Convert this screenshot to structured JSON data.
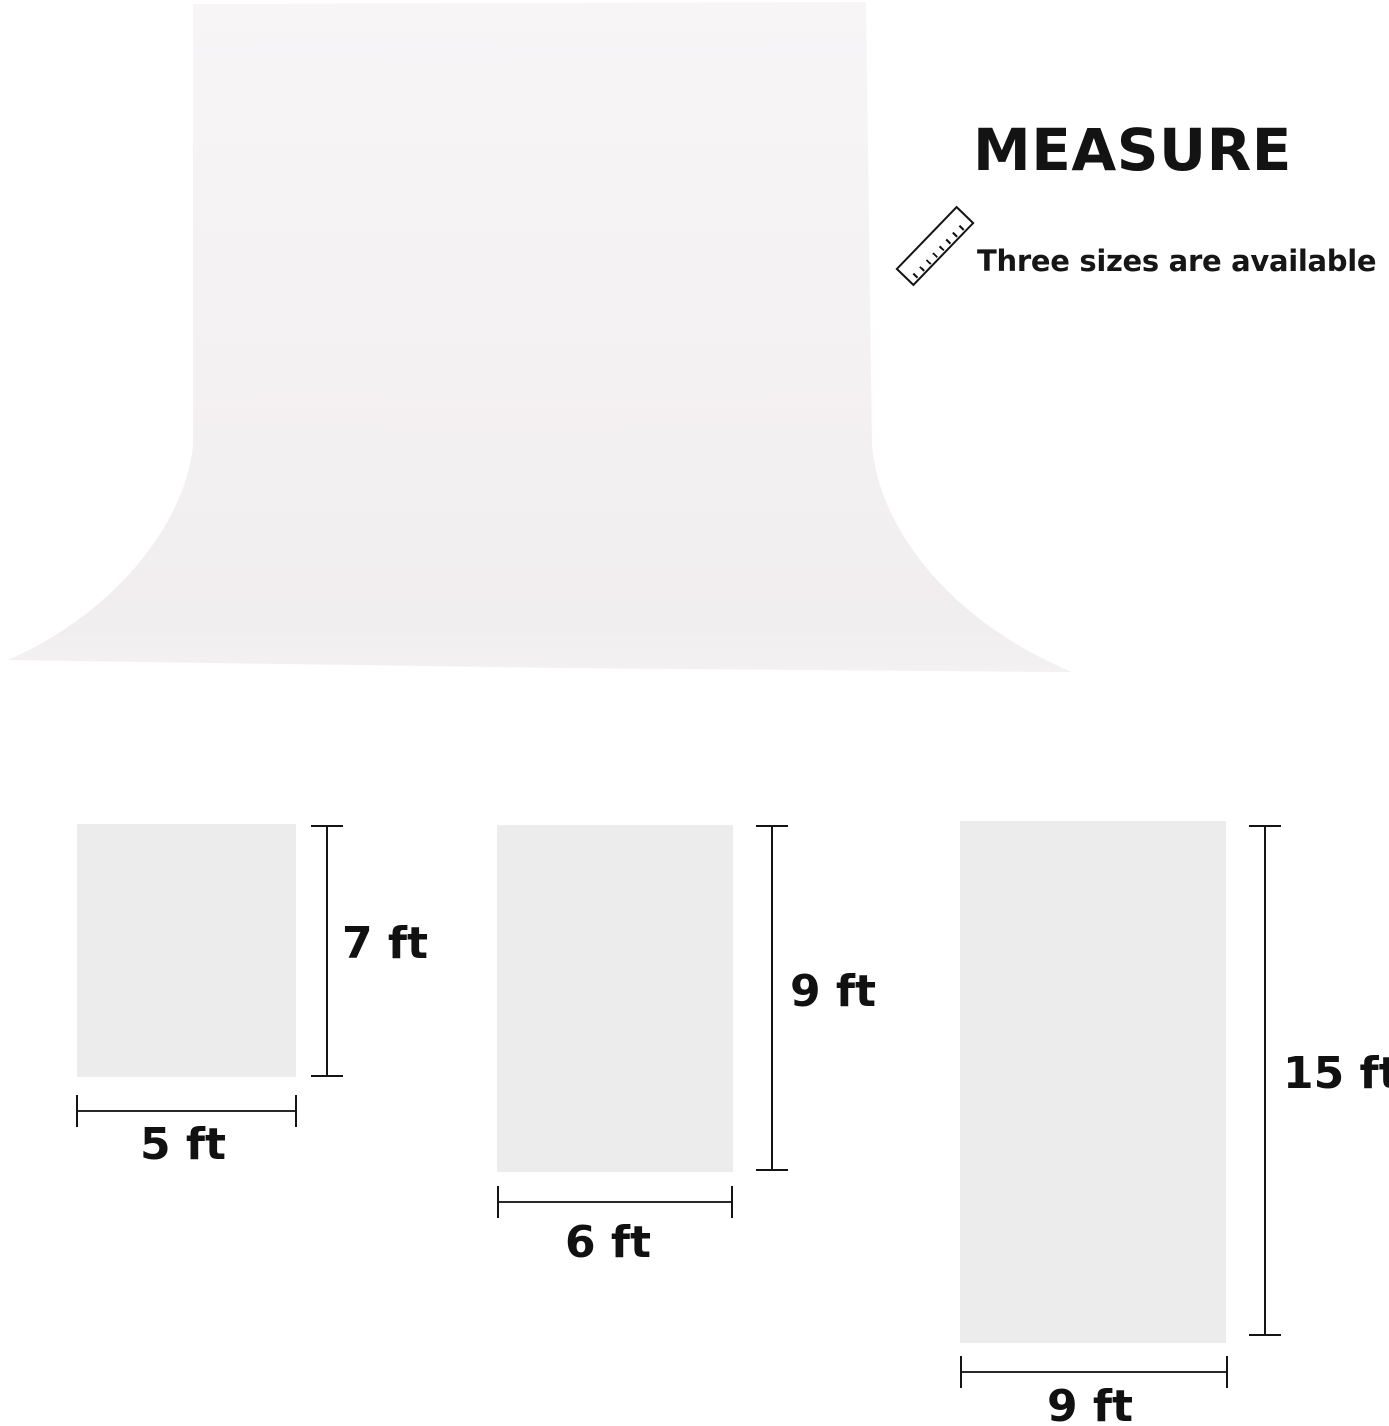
{
  "page": {
    "width": 1389,
    "height": 1426,
    "background": "#ffffff"
  },
  "header": {
    "title": "MEASURE",
    "subtitle": "Three sizes are available",
    "text_color": "#131313",
    "ruler_icon": "diagonal-ruler"
  },
  "backdrop": {
    "description": "white photography backdrop sweep",
    "fill_top": "#f7f5f6",
    "fill_bottom": "#f1eeef"
  },
  "line_color": "#141414",
  "swatch_color": "#ececec",
  "sizes": [
    {
      "width_ft": 5,
      "height_ft": 7,
      "width_label": "5 ft",
      "height_label": "7 ft"
    },
    {
      "width_ft": 6,
      "height_ft": 9,
      "width_label": "6 ft",
      "height_label": "9 ft"
    },
    {
      "width_ft": 9,
      "height_ft": 15,
      "width_label": "9 ft",
      "height_label": "15 ft"
    }
  ]
}
